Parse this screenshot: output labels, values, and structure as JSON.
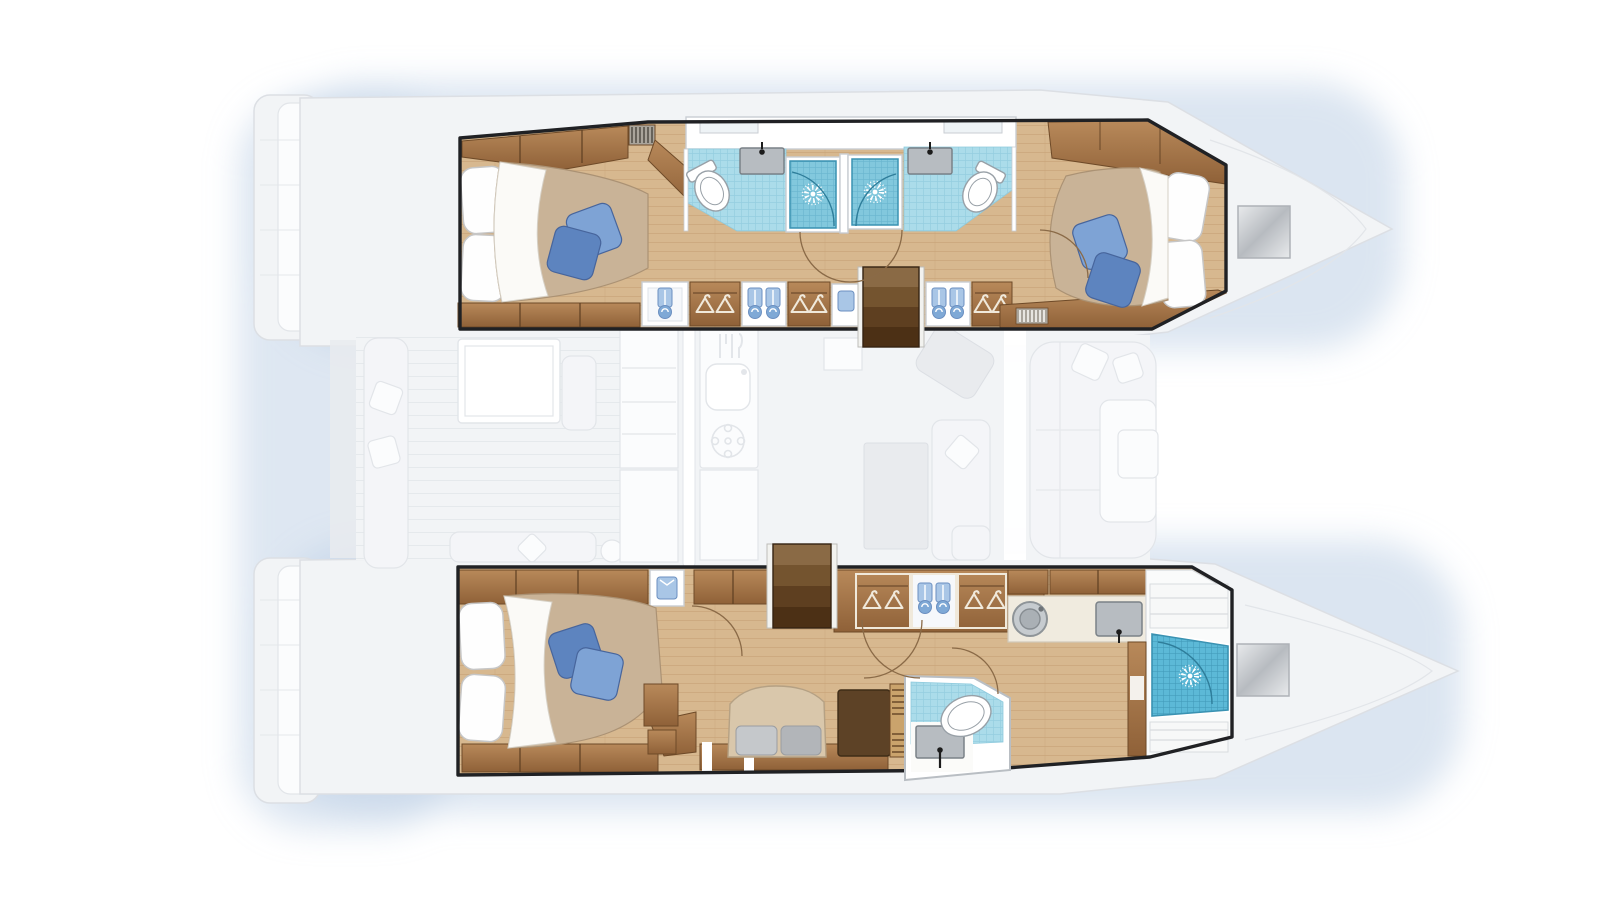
{
  "document": {
    "kind": "catamaran-yacht-floor-plan",
    "view": "top-down deck plan, hull accommodations highlighted in color over faded deck silhouette",
    "visible_text": []
  },
  "palette": {
    "bg": "#ffffff",
    "glow": "#bdd0e6",
    "glow_soft": "#d9e4f1",
    "faded_fill": "#f2f4f6",
    "faded_fill_dark": "#e9ebee",
    "faded_stroke": "#dcdfe4",
    "faded_white": "#fbfcfd",
    "faded_furn": "#f4f5f8",
    "faded_furn_stroke": "#e2e5e9",
    "faded_gray": "#e3e6ea",
    "walkway_white": "#ffffff",
    "outline": "#202124",
    "wall_white": "#ffffff",
    "wall_stroke": "#c9ced3",
    "wood_floor": "#d7b88f",
    "wood_floor_line": "#c29c6e",
    "cabinet_hi": "#b8895a",
    "cabinet_lo": "#8f6138",
    "cabinet_stroke": "#6e4a28",
    "wood_band_seam": "#5e3f22",
    "steps_light": "#8a6a45",
    "steps_mid": "#74542f",
    "steps_dark": "#5e3f20",
    "steps_deep": "#4c3015",
    "steps_stroke": "#352312",
    "steps_rail": "#f2f2ef",
    "bed_beige": "#c9b397",
    "bed_beige_stroke": "#ab9274",
    "sheet_white": "#fbfaf7",
    "sheet_stroke": "#d6d0c5",
    "pillow_white": "#fefefe",
    "pillow_stroke": "#c6c6c6",
    "pillow_blue": "#7ea3d5",
    "pillow_blue_dark": "#5d84bf",
    "pillow_blue_stroke": "#47659c",
    "tile_light": "#abdcea",
    "tile_light_line": "#8ecadd",
    "tile_mid": "#82c8dd",
    "tile_mid_line": "#62b0ca",
    "tile_deep": "#5cb9d7",
    "tile_deep_line": "#3d95b5",
    "tile_stroke": "#3a92b2",
    "shower_arc": "#2e7d9a",
    "fixture_white": "#ffffff",
    "fixture_stroke": "#98a0a7",
    "sink_gray": "#b7bcc1",
    "sink_stroke": "#7a8187",
    "faucet_black": "#1c1c1c",
    "counter_cream": "#f0ebdf",
    "counter_stroke": "#d0c9b8",
    "towel_blue": "#a9c6e6",
    "towel_blue_dark": "#7fa9d6",
    "towel_stroke": "#6b8fc0",
    "hanger_light": "#f0e9db",
    "sofa_beige": "#d9c7ab",
    "sofa_stroke": "#b5a184",
    "cushion_gray": "#c5c8cb",
    "cushion_gray_dark": "#b2b5b9",
    "cushion_stroke": "#9a9da1",
    "dark_cabinet": "#5d4226",
    "dark_cabinet_stroke": "#3e2c17",
    "vent_bg": "#a9a49b",
    "vent_slat": "#4a463f",
    "vent_slat_light": "#e8e6e1",
    "hatch_hi": "#e8eaec",
    "hatch_lo": "#b7bbc0",
    "hatch_stroke": "#aeb2b7",
    "door_arc": "#8a6a47"
  },
  "boat": {
    "top_hull": {
      "highlighted": true,
      "rooms": [
        {
          "name": "aft-guest-cabin",
          "features": [
            "double-bed",
            "white-pillows",
            "blue-accent-pillows",
            "headboard-shelf",
            "louver-vent"
          ]
        },
        {
          "name": "aft-bathroom",
          "features": [
            "toilet",
            "sink",
            "shower-stall",
            "shower-head"
          ]
        },
        {
          "name": "forward-bathroom",
          "features": [
            "shower-stall",
            "shower-head",
            "sink",
            "toilet"
          ]
        },
        {
          "name": "companionway-stairs",
          "features": [
            "four-treads"
          ]
        },
        {
          "name": "storage-corridor",
          "features": [
            "hanger-locker",
            "towel-locker",
            "hanger-locker",
            "towel-locker",
            "louver-vent"
          ]
        },
        {
          "name": "forward-guest-cabin",
          "features": [
            "double-bed",
            "white-pillows",
            "blue-accent-pillows"
          ]
        }
      ]
    },
    "bottom_hull": {
      "highlighted": true,
      "rooms": [
        {
          "name": "owner-cabin",
          "features": [
            "double-bed",
            "white-pillows",
            "blue-accent-pillows",
            "sofa",
            "gray-cushions",
            "side-cabinet",
            "nightstand"
          ]
        },
        {
          "name": "companionway-stairs",
          "features": [
            "four-treads"
          ]
        },
        {
          "name": "wardrobe-corridor",
          "features": [
            "hanger-locker",
            "towel-locker",
            "hanger-locker",
            "folded-shirt-cubby"
          ]
        },
        {
          "name": "vanity",
          "features": [
            "washing-machine",
            "sink",
            "cream-counter"
          ]
        },
        {
          "name": "toilet-room",
          "features": [
            "toilet",
            "sink",
            "blue-tile-floor"
          ]
        },
        {
          "name": "bow-shower-room",
          "features": [
            "large-shower",
            "shower-head",
            "shelves",
            "bench"
          ]
        }
      ]
    },
    "center_deck_faded": {
      "highlighted": false,
      "areas": [
        {
          "name": "aft-cockpit",
          "features": [
            "dining-table",
            "bench-seats",
            "lounge-pillows"
          ]
        },
        {
          "name": "galley",
          "features": [
            "sink",
            "stove",
            "cutlery-icon",
            "fridge",
            "island-counter"
          ]
        },
        {
          "name": "salon",
          "features": [
            "dinette-table",
            "l-sofa",
            "nav-seat",
            "scatter-pillows"
          ]
        },
        {
          "name": "forward-cockpit",
          "features": [
            "u-lounge",
            "pillows",
            "console"
          ]
        },
        {
          "name": "transom-steps",
          "features": [
            "swim-platforms"
          ]
        },
        {
          "name": "foredeck",
          "features": [
            "deck-hatch-port",
            "deck-hatch-starboard",
            "bow-lines"
          ]
        }
      ]
    }
  },
  "icons": {
    "shower-head-icon": "white sunburst (dot + radiating dashes)",
    "hanger-icon": "open triangle with hook",
    "towel-icon": "hanging blue towel with rolled end",
    "washer-icon": "concentric gray circles with dot",
    "louver-vent-icon": "slatted grille bars",
    "stairs-icon": "stacked darkening treads",
    "deck-hatch-icon": "gray square with diagonal sheen",
    "toilet-icon": "white oval bowl with rim",
    "sink-icon": "gray basin with black faucet dot"
  }
}
